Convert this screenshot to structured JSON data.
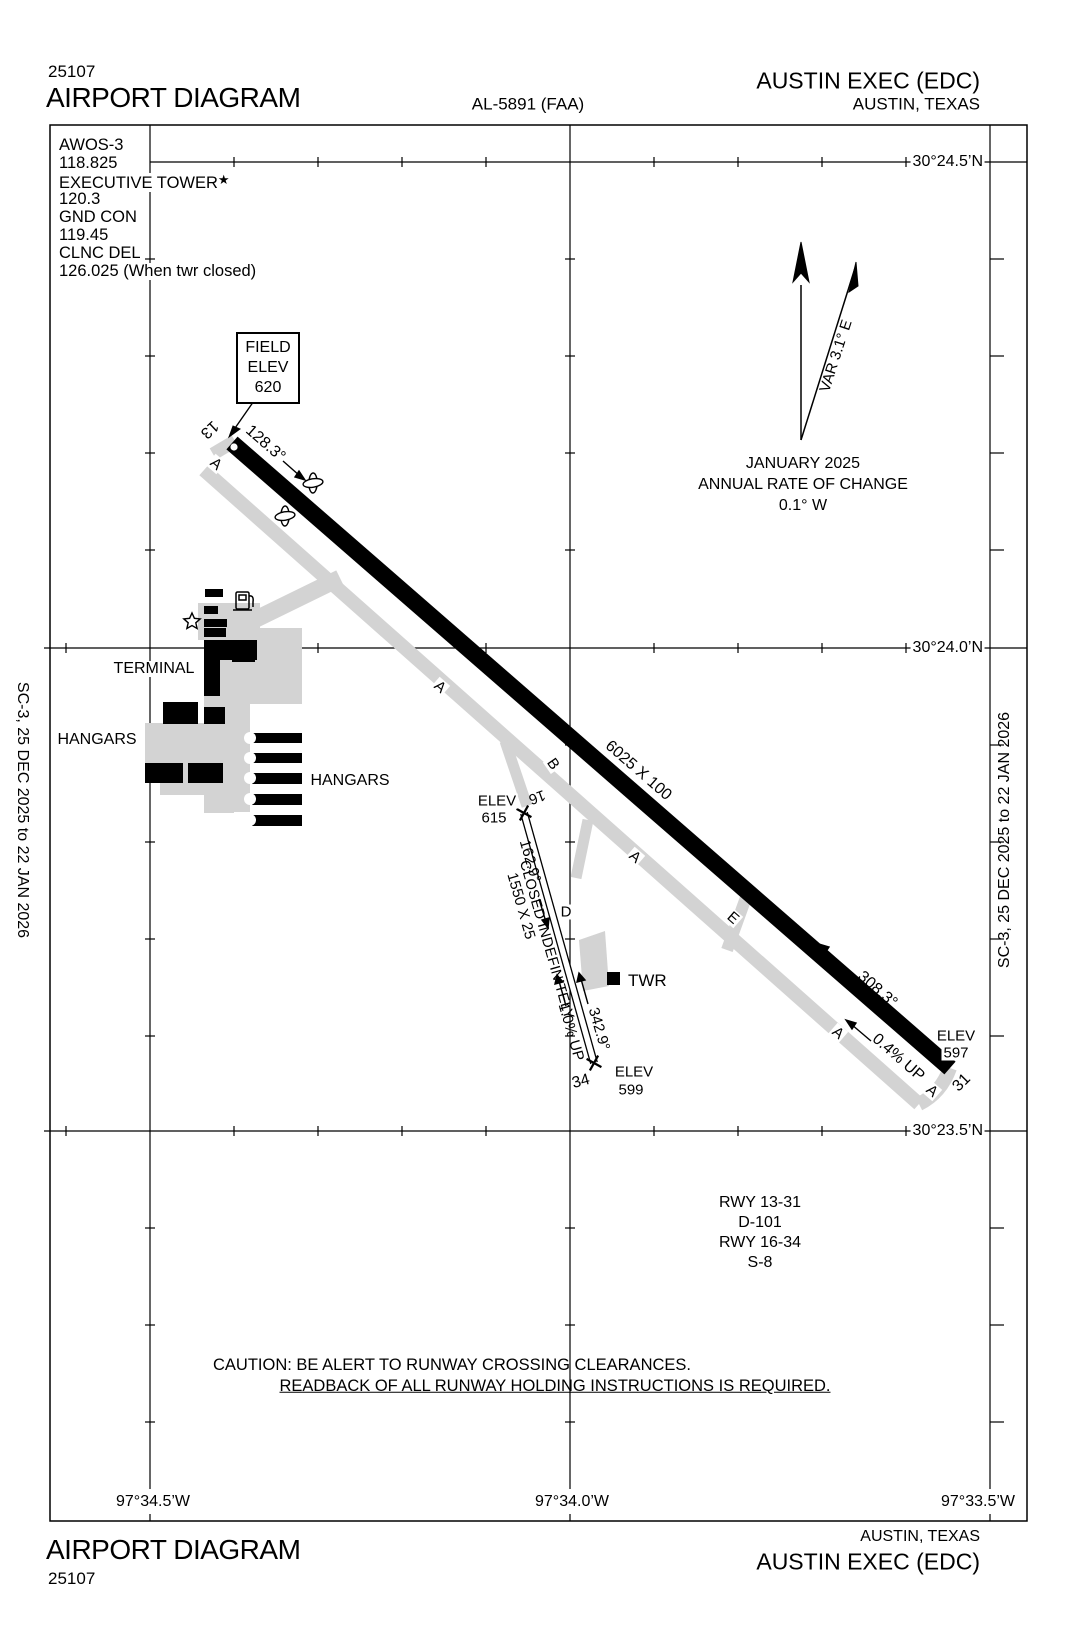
{
  "colors": {
    "ink": "#000000",
    "pavement": "#d3d3d3",
    "runway": "#000000",
    "background": "#ffffff"
  },
  "header": {
    "chart_number": "25107",
    "title": "AIRPORT DIAGRAM",
    "procedure_id": "AL-5891 (FAA)",
    "airport_name": "AUSTIN EXEC (EDC)",
    "city": "AUSTIN, TEXAS"
  },
  "comms": {
    "tower_star": "★",
    "lines": [
      "AWOS-3",
      "118.825",
      "EXECUTIVE TOWER",
      "120.3",
      "GND CON",
      "119.45",
      "CLNC DEL",
      "126.025 (When twr closed)"
    ]
  },
  "field_elevation": {
    "line1": "FIELD",
    "line2": "ELEV",
    "line3": "620"
  },
  "north": {
    "variation": "VAR 3.1° E",
    "date": "JANUARY 2025",
    "rate_label": "ANNUAL RATE OF CHANGE",
    "rate": "0.1° W"
  },
  "grid": {
    "latitudes": [
      "30°24.5’N",
      "30°24.0’N",
      "30°23.5’N"
    ],
    "longitudes": [
      "97°34.5’W",
      "97°34.0’W",
      "97°33.5’W"
    ]
  },
  "runway_13_31": {
    "id_13": "13",
    "id_31": "31",
    "dimensions": "6025 X 100",
    "heading_13": "128.3°",
    "heading_31": "308.3°",
    "gradient": "0.4% UP",
    "elev_label": "ELEV",
    "elev_31": "597"
  },
  "runway_16_34": {
    "id_16": "16",
    "id_34": "34",
    "dimensions": "1550 X 25",
    "status": "CLOSED INDEFINITELY",
    "heading_16": "162.9°",
    "heading_34": "342.9°",
    "gradient": "1.0% UP",
    "elev_label": "ELEV",
    "elev_16": "615",
    "elev_34": "599"
  },
  "taxiways": {
    "a": "A",
    "b": "B",
    "d": "D",
    "e": "E"
  },
  "facilities": {
    "terminal": "TERMINAL",
    "hangars": "HANGARS",
    "tower": "TWR"
  },
  "declared": {
    "lines": [
      "RWY 13-31",
      "D-101",
      "RWY 16-34",
      "S-8"
    ]
  },
  "caution": {
    "line1": "CAUTION: BE ALERT TO RUNWAY CROSSING CLEARANCES.",
    "line2": "READBACK OF ALL RUNWAY HOLDING INSTRUCTIONS IS REQUIRED."
  },
  "footer": {
    "title": "AIRPORT DIAGRAM",
    "chart_number": "25107",
    "city": "AUSTIN, TEXAS",
    "airport_name": "AUSTIN EXEC (EDC)"
  },
  "edge_note": "SC-3,  25 DEC 2025  to  22 JAN 2026"
}
